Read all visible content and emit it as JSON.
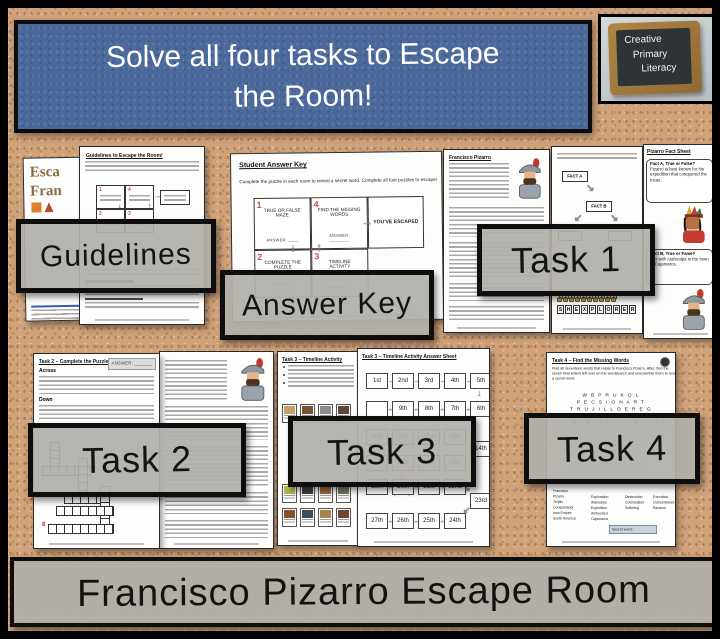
{
  "title_banner": {
    "line1": "Solve all four tasks to Escape",
    "line2": "the Room!"
  },
  "logo": {
    "lines": [
      "Creative",
      "Primary",
      "Literacy"
    ]
  },
  "banners": {
    "guidelines": "Guidelines",
    "answer_key": "Answer Key",
    "task1": "Task 1",
    "task2": "Task 2",
    "task3": "Task 3",
    "task4": "Task 4"
  },
  "bottom_banner": {
    "text": "Francisco Pizarro Escape Room"
  },
  "cover_page": {
    "word1": "Esca",
    "word2": "Fran"
  },
  "guidelines_page": {
    "title": "Guidelines to Escape the Room!"
  },
  "answer_key_page": {
    "title": "Student Answer Key",
    "instruction": "Complete the puzzle in each room to reveal a secret word. Complete all four puzzles to escape!",
    "flow": {
      "step1": {
        "num": "1",
        "label": "TRUE OR FALSE MAZE",
        "answer": "ANSWER: ____"
      },
      "step2": {
        "num": "2",
        "label": "COMPLETE THE PUZZLE",
        "answer": "ANSWER: ________"
      },
      "step3": {
        "num": "3",
        "label": "TIMELINE ACTIVITY",
        "answer": "ANSWER: ____"
      },
      "step4": {
        "num": "4",
        "label": "FIND THE MISSING WORDS",
        "answer": "ANSWER: ________"
      },
      "escaped": "YOU'VE ESCAPED"
    }
  },
  "pizarro_page": {
    "title": "Francisco Pizarro"
  },
  "maze_page": {
    "fact_a": "FACT A",
    "fact_b": "FACT B",
    "letters": [
      "S",
      "H",
      "E",
      "X",
      "P",
      "L",
      "O",
      "R",
      "E",
      "R"
    ]
  },
  "fact_sheet_page": {
    "title": "Pizarro Fact Sheet",
    "bubble1_heading": "Fact A, True or False?",
    "bubble1_text": "Pizarro is best known for his expedition that conquered the Incas.",
    "bubble2_heading": "Fact B, True or False?",
    "bubble2_text": "met with Atahualpa in the town of Cajamarca."
  },
  "task2_page": {
    "title": "Task 2 – Complete the Puzzle",
    "answer_label": "ANSWER: _______",
    "across": "Across",
    "down": "Down",
    "red_number": "8"
  },
  "task3_page": {
    "title": "Task 3 – Timeline Activity"
  },
  "task3_answer_page": {
    "title": "Task 3 – Timeline Activity Answer Sheet",
    "board": {
      "r1": [
        "1st",
        "2nd",
        "3rd",
        "4th",
        "5th"
      ],
      "r2": [
        "",
        "9th",
        "8th",
        "7th",
        "6th"
      ],
      "r3": [
        "10th",
        "11th",
        "12th",
        "13th"
      ],
      "r3_end": "14th",
      "r4": [
        "18th",
        "17th",
        "16th",
        "15th"
      ],
      "r5": [
        "19th",
        "20th",
        "21st",
        "22nd"
      ],
      "r5_end": "23rd",
      "r6": [
        "27th",
        "26th",
        "25th",
        "24th"
      ]
    }
  },
  "task4_page": {
    "title": "Task 4 – Find the Missing Words",
    "instruction": "Find all seventeen words that relate to Francisco Pizarro. After, find the seven final letters left over on the wordsearch and unscramble them to reveal a secret word.",
    "wordsearch_rows": [
      "W B P R U K O L",
      "P E C S I O N A R T",
      "T R U J I L L O E R E G",
      "B E R E X P E D I T I O N A",
      "T E R I W I N G U I T P I C O N"
    ],
    "wordsearch_bottom_row": "P A B L O N G",
    "word_columns": [
      [
        "Francisco",
        "Pizarro",
        "Trujillo",
        "Conquistador",
        "Inca Empire",
        "South America"
      ],
      [
        "Exploration",
        "Atahualpa",
        "Expedition",
        "Ambushed",
        "Cajamarca"
      ],
      [
        "Destruction",
        "Colonization",
        "Suffering"
      ],
      [
        "Execution",
        "Outnumbered",
        "Ransom"
      ]
    ],
    "secret_word_label": "Secret word:"
  },
  "colors": {
    "cork": "#cfa279",
    "banner_gray": "#b1afaa",
    "title_blue": "#4c699c",
    "accent_red": "#c75450"
  }
}
